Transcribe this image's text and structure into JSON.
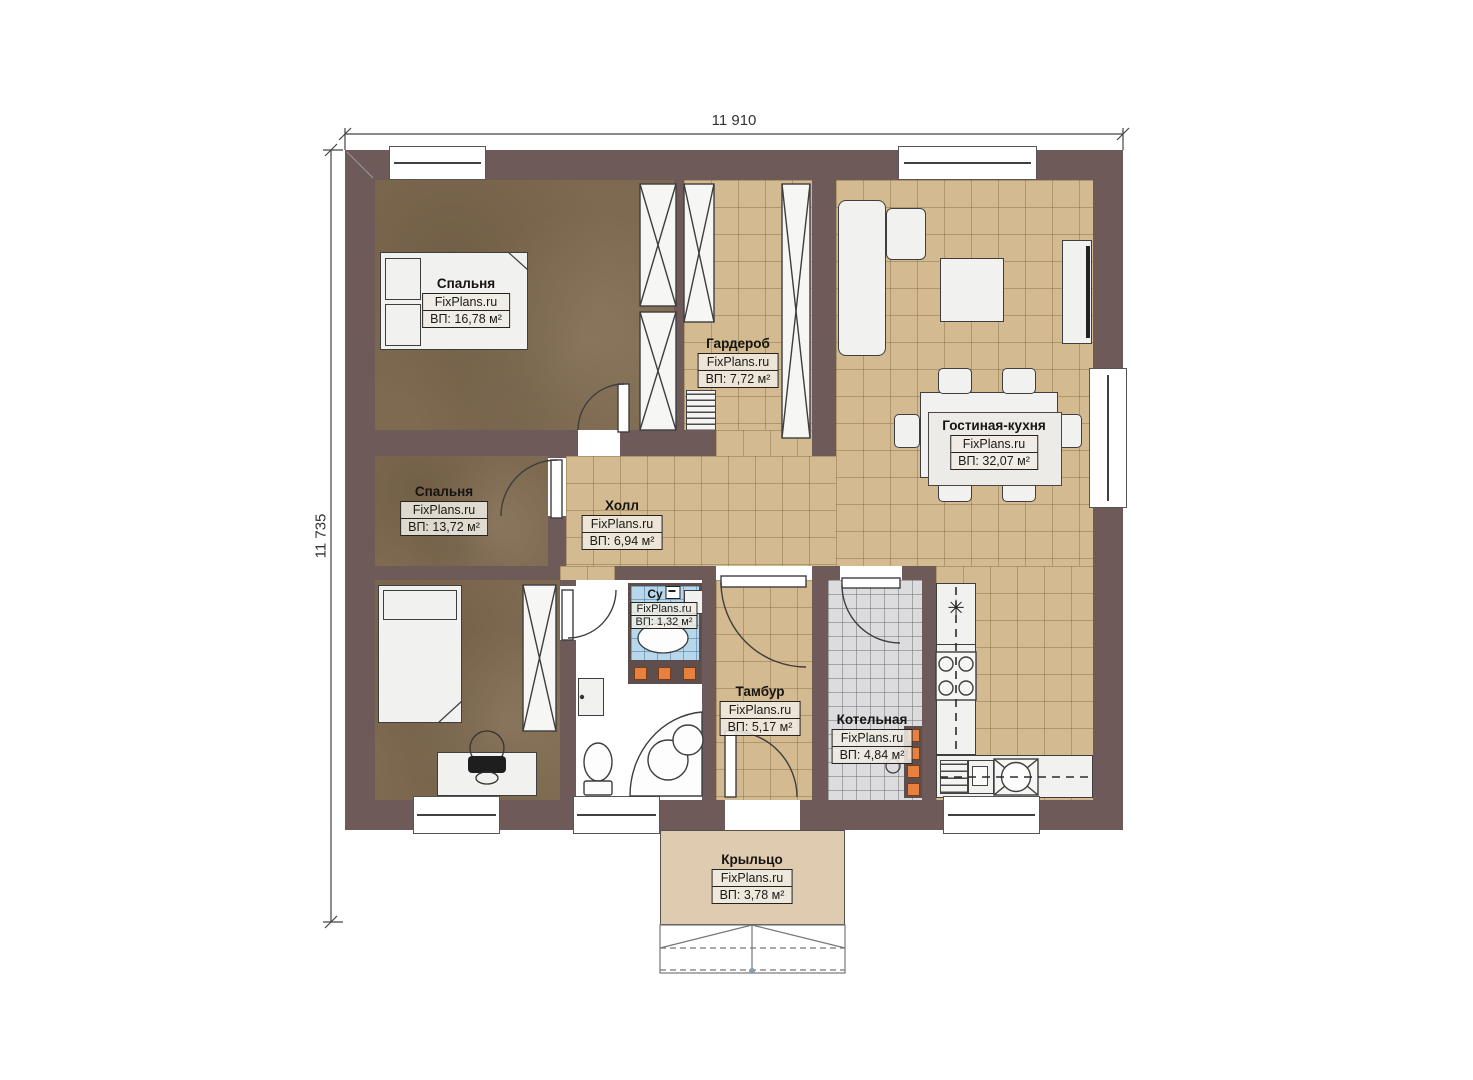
{
  "plan": {
    "watermark": "FixPlans.ru",
    "dimensions": {
      "width_label": "11 910",
      "height_label": "11 735"
    },
    "rooms": {
      "bedroom1": {
        "name": "Спальня",
        "area": "ВП: 16,78 м²"
      },
      "wardrobe": {
        "name": "Гардероб",
        "area": "ВП: 7,72 м²"
      },
      "living_kitchen": {
        "name": "Гостиная-кухня",
        "area": "ВП: 32,07 м²"
      },
      "bedroom2": {
        "name": "Спальня",
        "area": "ВП: 13,72 м²"
      },
      "hall": {
        "name": "Холл",
        "area": "ВП: 6,94 м²"
      },
      "bathroom": {
        "name": "Су",
        "area": "ВП: 1,32 м²"
      },
      "tambour": {
        "name": "Тамбур",
        "area": "ВП: 5,17 м²"
      },
      "boiler": {
        "name": "Котельная",
        "area": "ВП: 4,84 м²"
      },
      "porch": {
        "name": "Крыльцо",
        "area": "ВП: 3,78 м²"
      }
    },
    "icons": {
      "freezer_snowflake": "✳"
    },
    "colors": {
      "wall": "#6d5a59",
      "floor_wood": "#7e6a51",
      "floor_tile_beige": "#d3ba90",
      "floor_tile_gray": "#dcdcdf",
      "floor_tile_blue": "#b7d7ec",
      "porch_floor": "#dfcbb0",
      "boiler_accent": "#e8803f"
    }
  }
}
